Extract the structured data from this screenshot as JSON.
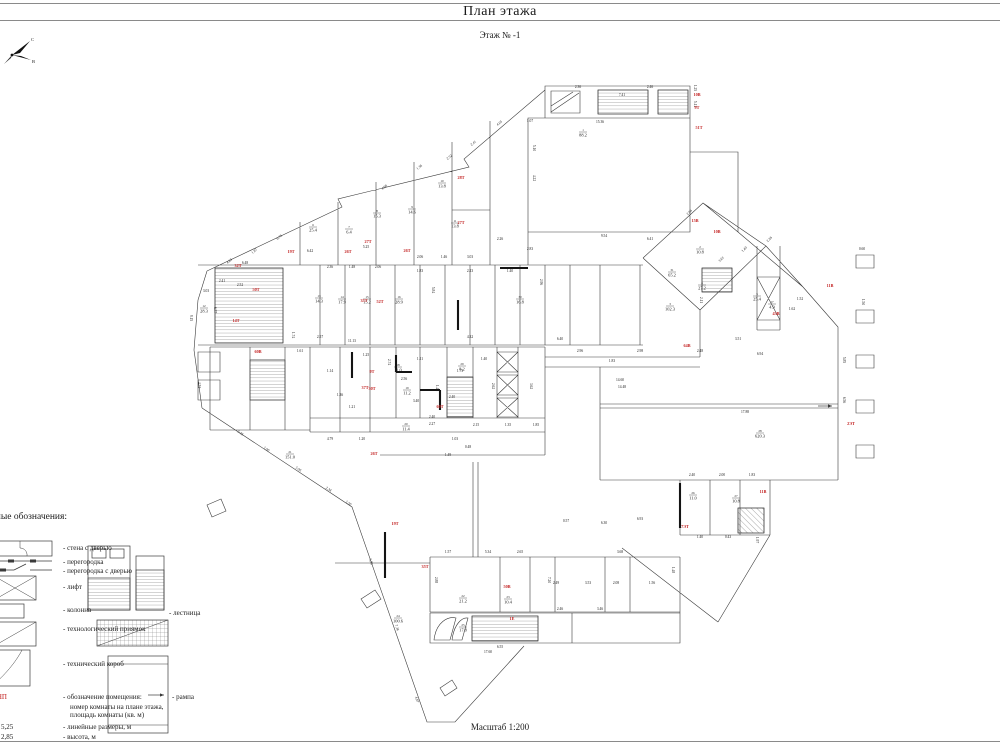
{
  "page": {
    "title": "План этажа",
    "subtitle": "Этаж № -1",
    "scale": "Масштаб 1:200"
  },
  "compass": {
    "north": "С",
    "east": "В"
  },
  "colors": {
    "red": "#c22020",
    "line": "#3a3a3a",
    "thick": "#141414"
  },
  "legend": {
    "heading": "Условные обозначения:",
    "texts": [
      {
        "t": "- стена с дверью",
        "x": 63,
        "y": 550,
        "s": 7
      },
      {
        "t": "- перегородка",
        "x": 63,
        "y": 564,
        "s": 7
      },
      {
        "t": "- перегородка с дверью",
        "x": 63,
        "y": 573,
        "s": 7
      },
      {
        "t": "- лифт",
        "x": 63,
        "y": 589,
        "s": 7
      },
      {
        "t": "- колонна",
        "x": 63,
        "y": 612,
        "s": 7
      },
      {
        "t": "- технологический приямок",
        "x": 63,
        "y": 631,
        "s": 7
      },
      {
        "t": "- технический короб",
        "x": 63,
        "y": 666,
        "s": 7
      },
      {
        "t": "1-НП",
        "x": -9,
        "y": 699,
        "s": 7,
        "c": "red"
      },
      {
        "t": "- обозначение помещения:",
        "x": 63,
        "y": 699,
        "s": 7
      },
      {
        "t": "номер комнаты на плане этажа,",
        "x": 70,
        "y": 709,
        "s": 7
      },
      {
        "t": "площадь комнаты (кв. м)",
        "x": 70,
        "y": 717,
        "s": 7
      },
      {
        "t": "5,25",
        "x": 1,
        "y": 729,
        "s": 7
      },
      {
        "t": "- линейные размеры, м",
        "x": 63,
        "y": 729,
        "s": 7
      },
      {
        "t": "2,85",
        "x": 1,
        "y": 739,
        "s": 7
      },
      {
        "t": "- высота, м",
        "x": 63,
        "y": 739,
        "s": 7
      },
      {
        "t": "- лестница",
        "x": 169,
        "y": 615,
        "s": 7
      },
      {
        "t": "- рампа",
        "x": 172,
        "y": 699,
        "s": 7
      }
    ]
  },
  "plan": {
    "red_labels": [
      [
        "32Т",
        238,
        267
      ],
      [
        "19Т",
        291,
        253
      ],
      [
        "26Т",
        348,
        253
      ],
      [
        "27Т",
        368,
        243
      ],
      [
        "26Т",
        407,
        252
      ],
      [
        "28Т",
        461,
        179
      ],
      [
        "27Т",
        461,
        224
      ],
      [
        "50Т",
        256,
        291
      ],
      [
        "14Т",
        236,
        322
      ],
      [
        "60В",
        258,
        353
      ],
      [
        "35Т",
        364,
        302
      ],
      [
        "52Т",
        380,
        303
      ],
      [
        "10В",
        697,
        96
      ],
      [
        "9Т",
        697,
        109
      ],
      [
        "51Т",
        699,
        129
      ],
      [
        "15В",
        695,
        222
      ],
      [
        "10В",
        717,
        233
      ],
      [
        "11В",
        830,
        287
      ],
      [
        "64В",
        687,
        347
      ],
      [
        "2ЭТ",
        851,
        425
      ],
      [
        "11В",
        763,
        493
      ],
      [
        "7ЭТ",
        685,
        528
      ],
      [
        "19Т",
        395,
        525
      ],
      [
        "35Т",
        425,
        568
      ],
      [
        "50В",
        507,
        588
      ],
      [
        "1Е",
        512,
        620
      ],
      [
        "9Т",
        372,
        373
      ],
      [
        "30Т",
        372,
        390
      ],
      [
        "60Т",
        440,
        408
      ],
      [
        "26Т",
        374,
        455
      ],
      [
        "37Т",
        365,
        389
      ],
      [
        "43В",
        776,
        315
      ]
    ],
    "rooms": [
      [
        "1",
        "88.2",
        583,
        133
      ],
      [
        "2",
        "10.8",
        700,
        250
      ],
      [
        "3",
        "102.3",
        670,
        307
      ],
      [
        "4",
        "27.2",
        702,
        286
      ],
      [
        "5",
        "25.4",
        757,
        297
      ],
      [
        "6",
        "25.4",
        313,
        228
      ],
      [
        "7",
        "6.4",
        349,
        230
      ],
      [
        "8",
        "15.3",
        377,
        214
      ],
      [
        "9",
        "14.6",
        412,
        210
      ],
      [
        "10",
        "13.8",
        442,
        184
      ],
      [
        "11",
        "13.8",
        455,
        224
      ],
      [
        "12",
        "28.3",
        204,
        309
      ],
      [
        "13",
        "14.3",
        319,
        299
      ],
      [
        "14",
        "17.9",
        342,
        300
      ],
      [
        "15",
        "15.2",
        367,
        300
      ],
      [
        "16",
        "28.9",
        399,
        300
      ],
      [
        "17",
        "4.9",
        772,
        305
      ],
      [
        "18",
        "11.0",
        398,
        368
      ],
      [
        "19",
        "11.2",
        407,
        391
      ],
      [
        "20",
        "11.4",
        406,
        427
      ],
      [
        "21",
        "151.0",
        290,
        455
      ],
      [
        "22",
        "21.2",
        463,
        599
      ],
      [
        "23",
        "10.4",
        508,
        600
      ],
      [
        "24",
        "100.6",
        398,
        619
      ],
      [
        "25",
        "17.8",
        463,
        628
      ],
      [
        "26",
        "11.0",
        693,
        496
      ],
      [
        "27",
        "10.8",
        736,
        499
      ],
      [
        "28",
        "620.3",
        760,
        434
      ],
      [
        "29",
        "8.2",
        462,
        367
      ],
      [
        "30",
        "16.8",
        520,
        300
      ],
      [
        "31",
        "65.2",
        672,
        273
      ]
    ],
    "dims": [
      [
        "15.36",
        600,
        123,
        0
      ],
      [
        "7.41",
        622,
        96,
        0
      ],
      [
        "2.46",
        650,
        88,
        0
      ],
      [
        "2.36",
        578,
        88,
        0
      ],
      [
        "5.11",
        694,
        104,
        90
      ],
      [
        "1.25",
        694,
        88,
        90
      ],
      [
        "5.10",
        533,
        148,
        90
      ],
      [
        "4.22",
        533,
        178,
        90
      ],
      [
        "1.07",
        530,
        122,
        0
      ],
      [
        "9.54",
        604,
        237,
        0
      ],
      [
        "6.41",
        650,
        240,
        0
      ],
      [
        "5.25",
        366,
        248,
        0
      ],
      [
        "6.42",
        310,
        252,
        0
      ],
      [
        "2.06",
        420,
        258,
        0
      ],
      [
        "1.46",
        444,
        258,
        0
      ],
      [
        "3.03",
        470,
        258,
        0
      ],
      [
        "2.26",
        500,
        240,
        0
      ],
      [
        "2.83",
        530,
        250,
        0
      ],
      [
        "4.05",
        500,
        124,
        -38
      ],
      [
        "2.41",
        474,
        144,
        -38
      ],
      [
        "2.52",
        450,
        158,
        -38
      ],
      [
        "1.36",
        420,
        168,
        -38
      ],
      [
        "4.98",
        385,
        188,
        -38
      ],
      [
        "6.76",
        280,
        238,
        -38
      ],
      [
        "4.63",
        230,
        262,
        -38
      ],
      [
        "1.87",
        255,
        252,
        -38
      ],
      [
        "9.15",
        190,
        318,
        90
      ],
      [
        "4.74",
        198,
        385,
        90
      ],
      [
        "3.03",
        206,
        292,
        0
      ],
      [
        "6.77",
        214,
        310,
        90
      ],
      [
        "5.84",
        432,
        290,
        90
      ],
      [
        "2.96",
        540,
        282,
        90
      ],
      [
        "6.40",
        560,
        340,
        0
      ],
      [
        "2.36",
        330,
        268,
        0
      ],
      [
        "1.48",
        352,
        268,
        0
      ],
      [
        "2.06",
        378,
        268,
        0
      ],
      [
        "1.83",
        420,
        272,
        0
      ],
      [
        "2.23",
        470,
        272,
        0
      ],
      [
        "1.40",
        510,
        272,
        0
      ],
      [
        "11.13",
        352,
        342,
        0
      ],
      [
        "4.32",
        470,
        338,
        0
      ],
      [
        "2.57",
        320,
        338,
        0
      ],
      [
        "1.74",
        292,
        335,
        90
      ],
      [
        "1.61",
        300,
        352,
        0
      ],
      [
        "6.48",
        245,
        264,
        0
      ],
      [
        "4.79",
        330,
        440,
        0
      ],
      [
        "1.20",
        362,
        440,
        0
      ],
      [
        "2.40",
        432,
        418,
        0
      ],
      [
        "2.27",
        432,
        425,
        0
      ],
      [
        "1.03",
        455,
        440,
        0
      ],
      [
        "0.48",
        468,
        448,
        0
      ],
      [
        "1.49",
        448,
        456,
        0
      ],
      [
        "5.45",
        240,
        434,
        33
      ],
      [
        "1.90",
        266,
        450,
        33
      ],
      [
        "5.96",
        298,
        470,
        33
      ],
      [
        "2.34",
        328,
        490,
        33
      ],
      [
        "1.50",
        348,
        504,
        33
      ],
      [
        "5.93",
        370,
        562,
        71
      ],
      [
        "7.36",
        396,
        628,
        71
      ],
      [
        "4.67",
        416,
        700,
        71
      ],
      [
        "14.60",
        620,
        381,
        0
      ],
      [
        "14.48",
        622,
        388,
        0
      ],
      [
        "17.88",
        745,
        413,
        0
      ],
      [
        "6.93",
        640,
        520,
        0
      ],
      [
        "6.30",
        604,
        524,
        0
      ],
      [
        "0.57",
        566,
        522,
        0
      ],
      [
        "6.56",
        843,
        400,
        90
      ],
      [
        "5.85",
        843,
        360,
        90
      ],
      [
        "1.52",
        800,
        300,
        0
      ],
      [
        "1.62",
        792,
        310,
        0
      ],
      [
        "2.26",
        770,
        240,
        -45
      ],
      [
        "1.40",
        745,
        250,
        -45
      ],
      [
        "2.06",
        690,
        213,
        -45
      ],
      [
        "3.61",
        722,
        260,
        -45
      ],
      [
        "2.11",
        700,
        300,
        90
      ],
      [
        "3.51",
        738,
        340,
        0
      ],
      [
        "6.94",
        760,
        355,
        0
      ],
      [
        "2.48",
        700,
        352,
        0
      ],
      [
        "2.98",
        640,
        352,
        0
      ],
      [
        "1.83",
        612,
        362,
        0
      ],
      [
        "2.96",
        580,
        352,
        0
      ],
      [
        "7.20",
        548,
        580,
        90
      ],
      [
        "3.68",
        620,
        553,
        0
      ],
      [
        "2.65",
        520,
        553,
        0
      ],
      [
        "5.34",
        488,
        553,
        0
      ],
      [
        "1.57",
        448,
        553,
        0
      ],
      [
        "2.88",
        435,
        580,
        90
      ],
      [
        "6.55",
        500,
        648,
        0
      ],
      [
        "17.60",
        488,
        653,
        0
      ],
      [
        "1.14",
        330,
        372,
        0
      ],
      [
        "1.21",
        352,
        408,
        0
      ],
      [
        "1.36",
        340,
        396,
        0
      ],
      [
        "1.25",
        366,
        356,
        0
      ],
      [
        "2.74",
        388,
        362,
        90
      ],
      [
        "2.56",
        404,
        380,
        0
      ],
      [
        "1.11",
        420,
        360,
        0
      ],
      [
        "3.40",
        416,
        402,
        0
      ],
      [
        "1.46",
        436,
        388,
        90
      ],
      [
        "1.73",
        460,
        372,
        0
      ],
      [
        "2.40",
        452,
        398,
        0
      ],
      [
        "1.40",
        484,
        360,
        0
      ],
      [
        "2.62",
        492,
        386,
        90
      ],
      [
        "3.62",
        530,
        386,
        90
      ],
      [
        "2.15",
        476,
        426,
        0
      ],
      [
        "1.35",
        508,
        426,
        0
      ],
      [
        "1.85",
        536,
        426,
        0
      ],
      [
        "2.49",
        556,
        584,
        0
      ],
      [
        "3.53",
        588,
        584,
        0
      ],
      [
        "2.08",
        616,
        584,
        0
      ],
      [
        "1.56",
        652,
        584,
        0
      ],
      [
        "1.48",
        672,
        570,
        90
      ],
      [
        "3.46",
        600,
        610,
        0
      ],
      [
        "2.46",
        560,
        610,
        0
      ],
      [
        "2.40",
        692,
        476,
        0
      ],
      [
        "2.00",
        722,
        476,
        0
      ],
      [
        "1.83",
        752,
        476,
        0
      ],
      [
        "1.40",
        700,
        538,
        0
      ],
      [
        "0.43",
        728,
        538,
        0
      ],
      [
        "1.97",
        756,
        540,
        90
      ],
      [
        "0.60",
        862,
        250,
        0
      ],
      [
        "1.50",
        862,
        302,
        90
      ],
      [
        "2.41",
        222,
        282,
        0
      ],
      [
        "2.52",
        240,
        286,
        0
      ]
    ]
  }
}
